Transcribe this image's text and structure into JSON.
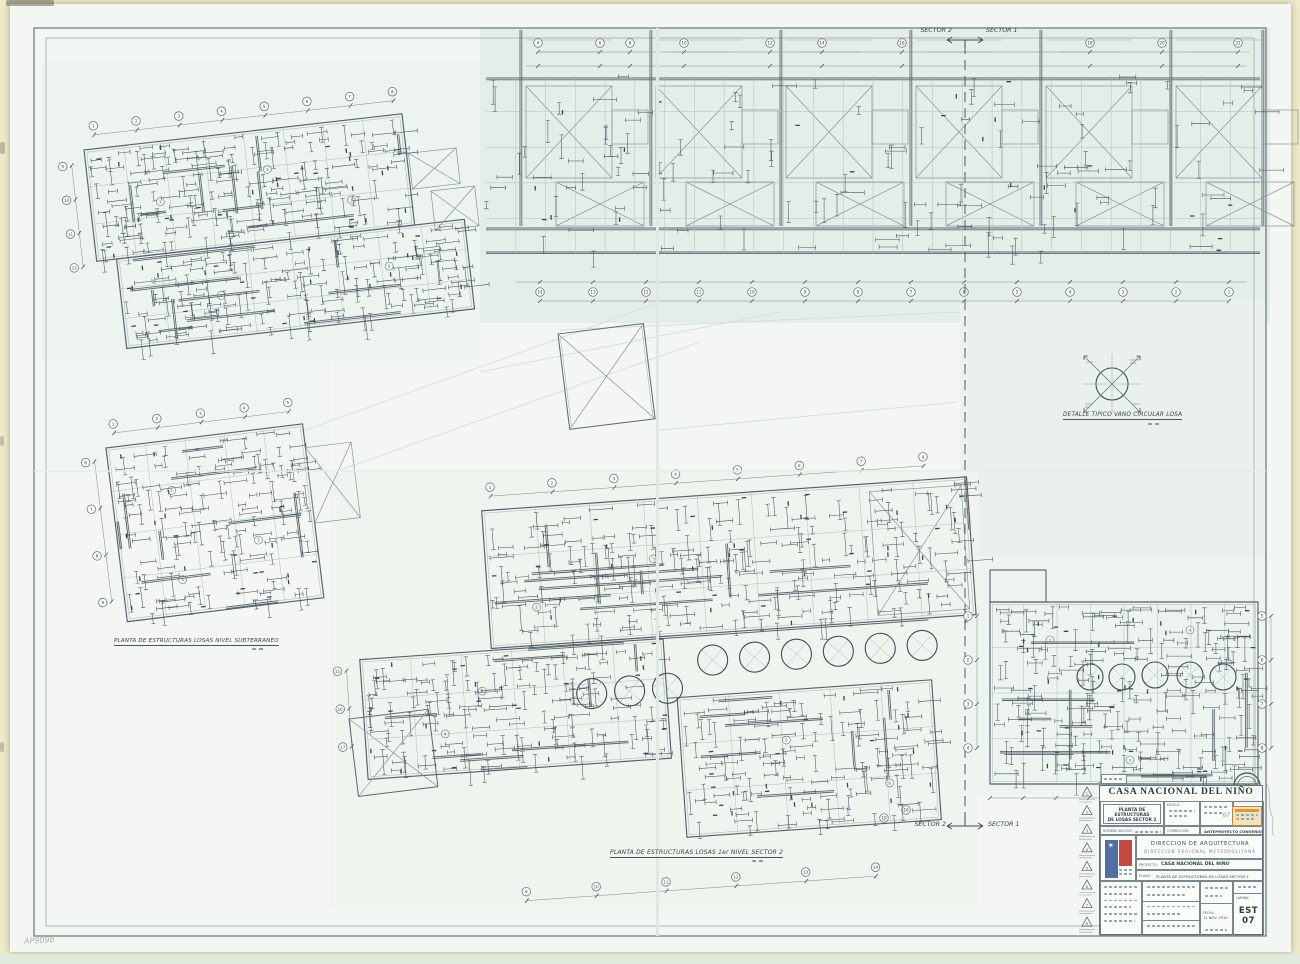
{
  "sheet": {
    "edge_note": "AP909b"
  },
  "colors": {
    "paper": "#f3f6f2",
    "tint": "#e3ede7",
    "line": "#5a6770",
    "line_faint": "#9fb0b2",
    "mark": "#46525a",
    "accent_blue": "#4f6fa0",
    "accent_red": "#c34a3c",
    "stamp_green": "#4e6a54",
    "stamp_orange": "#c8862f",
    "edge_cream": "#f2edcd"
  },
  "match_line": {
    "left_label": "SECTOR 2",
    "right_label": "SECTOR 1"
  },
  "captions": {
    "plan_subterraneo": "PLANTA DE ESTRUCTURAS LOSAS NIVEL SUBTERRANEO",
    "plan_primer_nivel": "PLANTA DE ESTRUCTURAS LOSAS 1er NIVEL SECTOR 2",
    "detalle_vano": "DETALLE TIPICO VANO CIRCULAR LOSA"
  },
  "title_block": {
    "header": "CASA NACIONAL DEL NIÑO",
    "subject_line1": "PLANTA DE ESTRUCTURAS",
    "subject_line2": "DE LOSAS SECTOR 2",
    "scale_label": "ESCALA",
    "file_label": "NOMBRE ARCHIVO",
    "correction_label": "CORRECCION",
    "stage": "ANTEPROYECTO CONVENIO",
    "agency": "DIRECCION DE ARQUITECTURA",
    "agency_sub": "DIRECCION REGIONAL METROPOLITANA",
    "project_label": "PROYECTO:",
    "project_value": "CASA NACIONAL DEL NIÑO",
    "plan_label": "PLANO:",
    "plan_value": "PLANTA DE ESTRUCTURAS DE LOSAS SECTOR 2",
    "date_label": "FECHA:",
    "date_value": "11 NOV. 2010",
    "sheet_label": "LAMINA:",
    "sheet_number": "EST 07",
    "stamp_letter": "D"
  },
  "revision_triangles": [
    "1",
    "2",
    "3",
    "4",
    "5",
    "6",
    "7",
    "8"
  ],
  "grid_bubbles": {
    "strip_top": [
      "4",
      "6",
      "8",
      "10",
      "12",
      "14",
      "16",
      "18",
      "20",
      "22"
    ],
    "strip_bottom": [
      "14",
      "13",
      "12",
      "11",
      "10",
      "9",
      "8",
      "7",
      "6",
      "5",
      "4",
      "3",
      "2",
      "1"
    ],
    "plan_a_top": [
      "1",
      "2",
      "3",
      "4",
      "5",
      "6",
      "7",
      "8"
    ],
    "plan_a_left": [
      "9",
      "10",
      "11",
      "12"
    ],
    "plan_c_top": [
      "1",
      "2",
      "3",
      "4",
      "5"
    ],
    "plan_c_left": [
      "6",
      "7",
      "8",
      "9"
    ],
    "plan_d_top": [
      "1",
      "2",
      "3",
      "4",
      "5",
      "6",
      "7",
      "8"
    ],
    "plan_d_bottom": [
      "9",
      "10",
      "11",
      "12",
      "13",
      "14"
    ],
    "plan_d_left": [
      "15",
      "16",
      "17"
    ],
    "plan_e_left": [
      "1",
      "2",
      "3",
      "4"
    ],
    "plan_e_right": [
      "5",
      "6",
      "7",
      "8"
    ],
    "near_matchline": [
      "16",
      "10"
    ]
  },
  "panel_marks": [
    "1",
    "2",
    "3",
    "4",
    "5",
    "6"
  ]
}
